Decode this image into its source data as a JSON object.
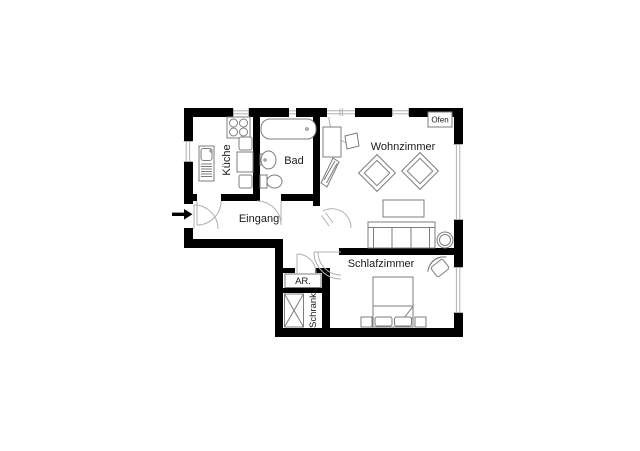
{
  "floor_plan": {
    "labels": {
      "kitchen": "Küche",
      "bath": "Bad",
      "entrance": "Eingang",
      "living_room": "Wohnzimmer",
      "bedroom": "Schlafzimmer",
      "storage_room": "AR.",
      "closet": "Schrank",
      "oven": "Ofen"
    },
    "colors": {
      "wall": "#000000",
      "furniture": "#7d7d7d",
      "door_arc": "#b0b0b0",
      "text": "#1a1a1a",
      "background": "#ffffff"
    }
  }
}
